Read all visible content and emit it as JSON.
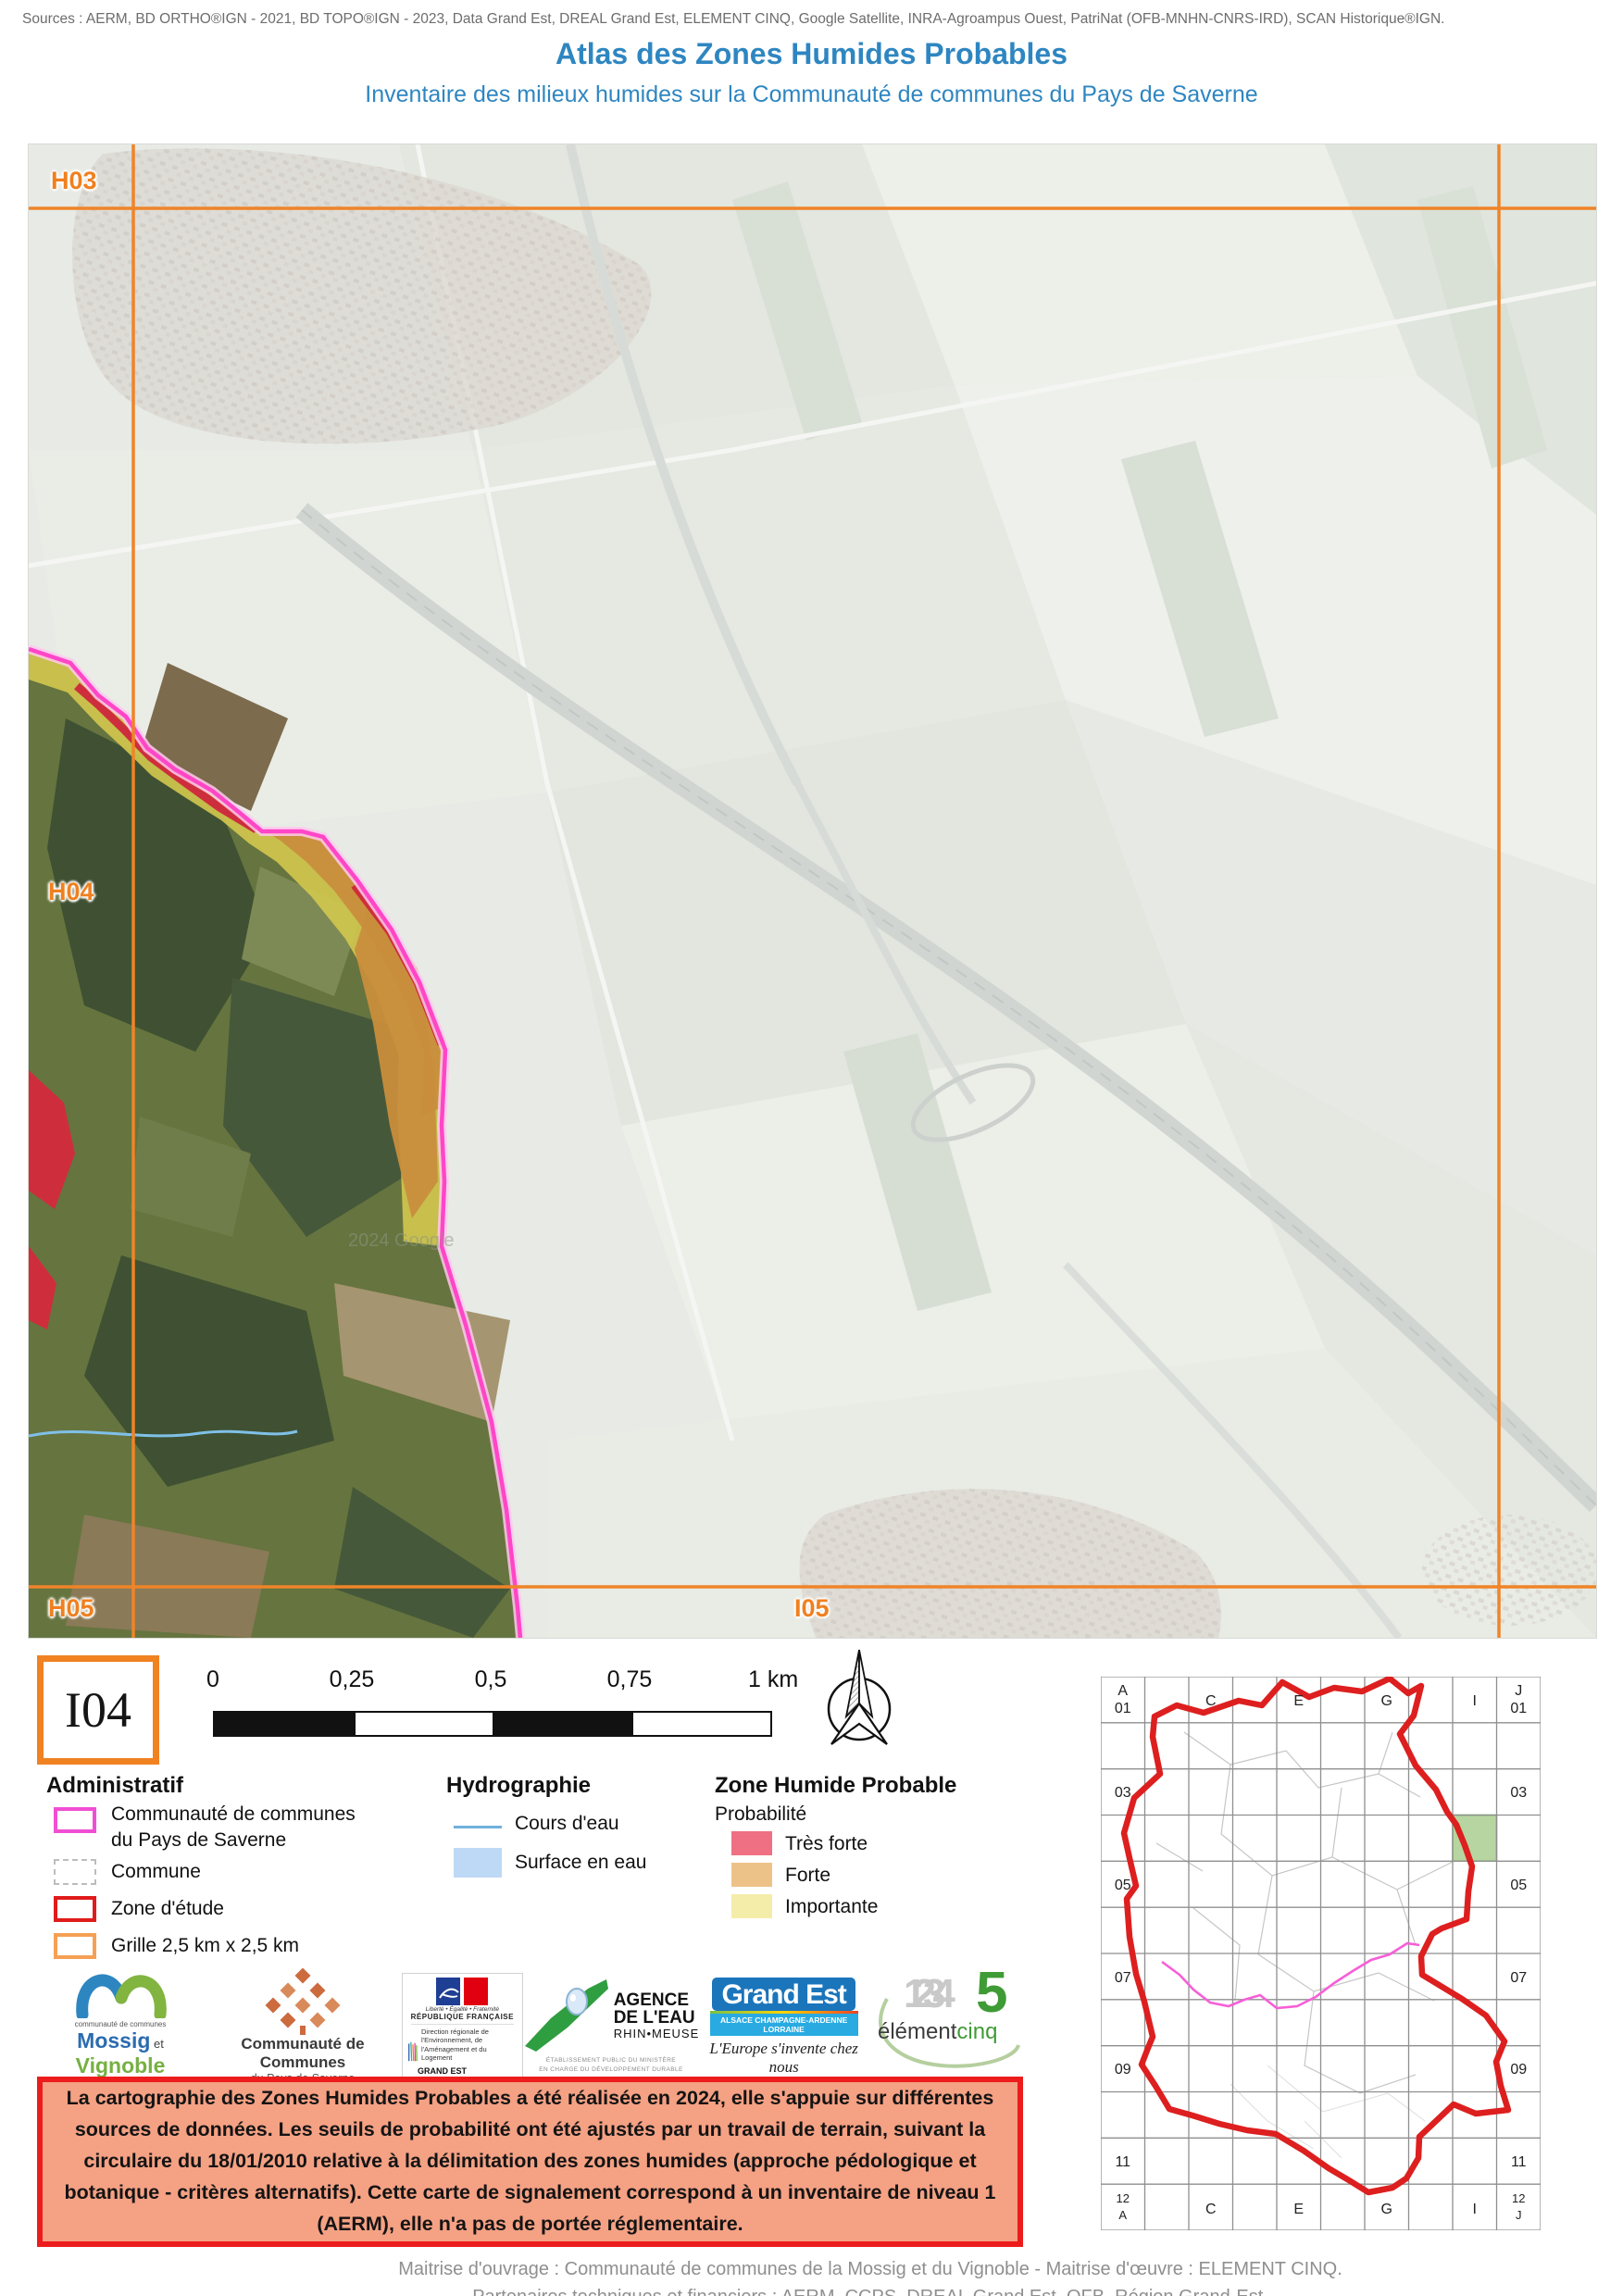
{
  "page": {
    "sources": "Sources : AERM, BD ORTHO®IGN - 2021, BD TOPO®IGN - 2023, Data Grand Est, DREAL Grand Est, ELEMENT CINQ, Google Satellite, INRA-Agroampus Ouest, PatriNat (OFB-MNHN-CNRS-IRD), SCAN Historique®IGN.",
    "title": "Atlas des Zones Humides Probables",
    "subtitle": "Inventaire des milieux humides sur la Communauté de communes du Pays de Saverne"
  },
  "map": {
    "cell_id": "I04",
    "labels": {
      "top_left": "H03",
      "mid_left": "H04",
      "bottom_left": "H05",
      "bottom_center": "I05"
    },
    "watermark": "2024 Google"
  },
  "scalebar": {
    "ticks": [
      "0",
      "0,25",
      "0,5",
      "0,75"
    ],
    "end": "1 km"
  },
  "legend": {
    "administratif": {
      "title": "Administratif",
      "items": [
        {
          "label1": "Communauté de communes",
          "label2": "du Pays de Saverne",
          "color": "#f04fd3"
        },
        {
          "label": "Commune",
          "color": "#bdbdbd"
        },
        {
          "label": "Zone d'étude",
          "color": "#e01b1b"
        },
        {
          "label": "Grille 2,5 km x 2,5 km",
          "color": "#f5a054"
        }
      ]
    },
    "hydrographie": {
      "title": "Hydrographie",
      "items": [
        {
          "label": "Cours d'eau",
          "color": "#6fb1dd"
        },
        {
          "label": "Surface en eau",
          "color": "#bdd9f5"
        }
      ]
    },
    "zone_humide": {
      "title": "Zone Humide Probable",
      "subtitle": "Probabilité",
      "items": [
        {
          "label": "Très forte",
          "color": "#ee7082"
        },
        {
          "label": "Forte",
          "color": "#edc289"
        },
        {
          "label": "Importante",
          "color": "#f4edaa"
        }
      ]
    }
  },
  "logos": {
    "mossig": {
      "cc": "communauté de communes",
      "name1": "Mossig",
      "et": " et ",
      "name2": "Vignoble",
      "region": "Alsace"
    },
    "ccps": {
      "line1": "Communauté de Communes",
      "line2": "du Pays de Saverne"
    },
    "dreal": {
      "motto": "Liberté • Égalité • Fraternité",
      "republic": "RÉPUBLIQUE FRANÇAISE",
      "dir": "Direction régionale de l'Environnement, de l'Aménagement et du Logement",
      "region": "GRAND EST"
    },
    "agence": {
      "l1": "AGENCE",
      "l2": "DE L'EAU",
      "l3": "RHIN•MEUSE",
      "sub1": "ÉTABLISSEMENT PUBLIC DU MINISTÈRE",
      "sub2": "EN CHARGE DU DÉVELOPPEMENT DURABLE"
    },
    "grandest": {
      "name": "Grand Est",
      "strip": "ALSACE CHAMPAGNE-ARDENNE LORRAINE",
      "tagline": "L'Europe s'invente chez nous"
    },
    "elementcinq": {
      "numbers": "1234",
      "five": "5",
      "word1": "élément",
      "word2": "cinq"
    }
  },
  "notice": {
    "text": "La cartographie des Zones Humides Probables a été réalisée en 2024, elle s'appuie sur différentes sources de données. Les seuils de probabilité ont été ajustés par un travail de terrain, suivant la circulaire du 18/01/2010 relative à la délimitation des zones humides (approche pédologique et botanique - critères alternatifs). Cette carte de signalement correspond à un inventaire de niveau 1 (AERM), elle n'a pas de portée réglementaire."
  },
  "overview": {
    "top_left": [
      "A",
      "01"
    ],
    "top_right": [
      "J",
      "01"
    ],
    "top_cols": [
      "C",
      "E",
      "G",
      "I"
    ],
    "bottom_cols": [
      "C",
      "E",
      "G",
      "I"
    ],
    "bottom_left": [
      "12",
      "A"
    ],
    "bottom_right": [
      "12",
      "J"
    ],
    "left_rows": [
      "03",
      "05",
      "07",
      "09",
      "11"
    ],
    "right_rows": [
      "03",
      "05",
      "07",
      "09",
      "11"
    ],
    "highlight_cell": "I04",
    "highlight_color": "#b7d5a0"
  },
  "credits": {
    "line1": "Maitrise d'ouvrage : Communauté de communes de la Mossig et du Vignoble - Maitrise d'œuvre : ELEMENT CINQ.",
    "line2": "Partenaires techniques et financiers : AERM, CCPS, DREAL Grand Est, OFB, Région Grand-Est."
  },
  "colors": {
    "title_blue": "#2e86c1",
    "grid_orange": "#ef8428",
    "boundary_pink": "#ff46c7",
    "study_red": "#dd1f1f",
    "wetland_tres_forte": "#ce2e3c",
    "wetland_forte": "#c98e3c",
    "wetland_importante": "#d3c84e",
    "notice_bg": "#f5a184",
    "notice_border": "#ed1c1c"
  }
}
